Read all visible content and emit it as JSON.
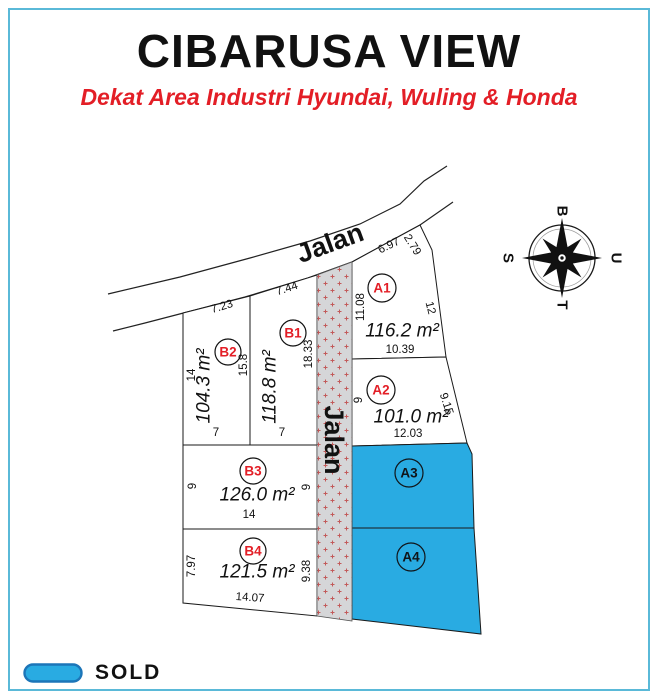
{
  "page": {
    "title": "CIBARUSA VIEW",
    "subtitle": "Dekat Area Industri Hyundai, Wuling & Honda"
  },
  "roads": {
    "top_label": "Jalan",
    "side_label": "Jalan"
  },
  "compass": {
    "west": "B",
    "north": "U",
    "east": "T",
    "south": "S",
    "north_color": "#c00000"
  },
  "plots": [
    {
      "id": "A1",
      "area": "116.2 m²",
      "status": "available",
      "dims": {
        "top": "6.97",
        "top_right": "2.79",
        "left": "11.08",
        "right": "12",
        "bottom": "10.39"
      }
    },
    {
      "id": "A2",
      "area": "101.0 m²",
      "status": "available",
      "dims": {
        "left": "9",
        "right": "9.15",
        "bottom": "12.03"
      }
    },
    {
      "id": "A3",
      "status": "sold"
    },
    {
      "id": "A4",
      "status": "sold"
    },
    {
      "id": "B1",
      "area": "118.8 m²",
      "status": "available",
      "dims": {
        "top": "7.44",
        "right": "18.33",
        "bottom": "7"
      }
    },
    {
      "id": "B2",
      "area": "104.3 m²",
      "status": "available",
      "dims": {
        "top": "7.23",
        "left": "14",
        "right": "15.8",
        "bottom": "7"
      }
    },
    {
      "id": "B3",
      "area": "126.0 m²",
      "status": "available",
      "dims": {
        "left": "9",
        "right": "9",
        "bottom": "14"
      }
    },
    {
      "id": "B4",
      "area": "121.5 m²",
      "status": "available",
      "dims": {
        "left": "7.97",
        "right": "9.38",
        "bottom": "14.07"
      }
    }
  ],
  "legend": {
    "sold_label": "SOLD",
    "sold_color": "#29abe2"
  },
  "colors": {
    "sold_fill": "#29abe2",
    "accent_red": "#e31e26",
    "border_blue": "#5ab9d8"
  }
}
